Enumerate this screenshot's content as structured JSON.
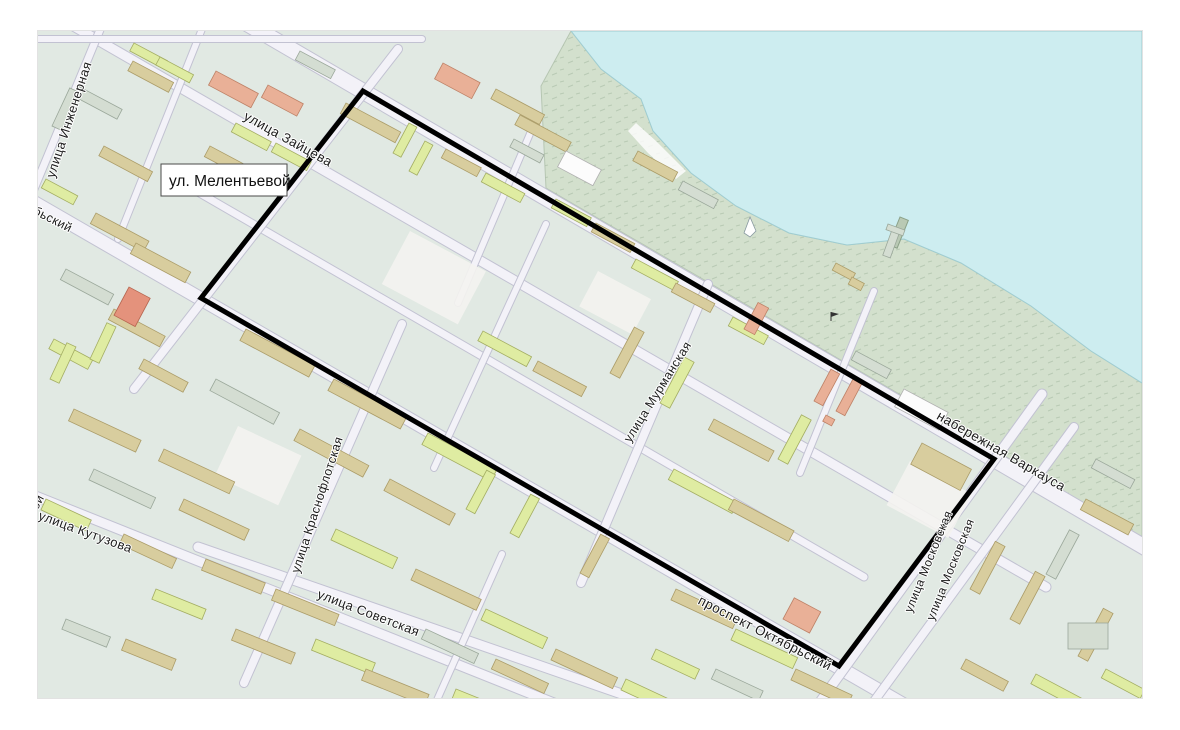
{
  "page": {
    "background": "#ffffff"
  },
  "map": {
    "kind": "city-plan",
    "colors": {
      "water": "#cdedf0",
      "shore": "#d3e0cd",
      "block": "#e1e9e3",
      "road_fill": "#f3f2f8",
      "road_casing": "#c2c2d2",
      "boundary": "#000000",
      "building_lime": "#dfeca2",
      "building_tan": "#d8cd9e",
      "building_salmon": "#e9b097"
    },
    "area_label_box": {
      "text": "ул. Мелентьевой"
    },
    "boundary": {
      "points": "325,60 956,428 801,635 163,267",
      "color": "#000000",
      "stroke_width": 5
    },
    "street_labels": [
      {
        "text": "улица Инженерная",
        "x": 35,
        "y": 90,
        "rot": -72,
        "size": 13
      },
      {
        "text": "улица Зайцева",
        "x": 248,
        "y": 112,
        "rot": 29,
        "size": 13.5
      },
      {
        "text": "бьский",
        "x": 13,
        "y": 192,
        "rot": 27,
        "size": 12.5
      },
      {
        "text": "ой",
        "x": 3,
        "y": 473,
        "rot": -62,
        "size": 12.5
      },
      {
        "text": "улица Кутузова",
        "x": 46,
        "y": 505,
        "rot": 20,
        "size": 13
      },
      {
        "text": "улица Краснофлотская",
        "x": 283,
        "y": 475,
        "rot": -72,
        "size": 12.5
      },
      {
        "text": "улица Советская",
        "x": 329,
        "y": 586,
        "rot": 21,
        "size": 13
      },
      {
        "text": "улица Мурманская",
        "x": 623,
        "y": 363,
        "rot": -58,
        "size": 12.5
      },
      {
        "text": "проспект Октябрьский",
        "x": 725,
        "y": 606,
        "rot": 27,
        "size": 13.5
      },
      {
        "text": "улица Московская",
        "x": 894,
        "y": 532,
        "rot": -68,
        "size": 12
      },
      {
        "text": "улица Московская",
        "x": 916,
        "y": 540,
        "rot": -68,
        "size": 12
      },
      {
        "text": "набережная Варкауса",
        "x": 961,
        "y": 424,
        "rot": 30,
        "size": 13.5
      }
    ]
  }
}
